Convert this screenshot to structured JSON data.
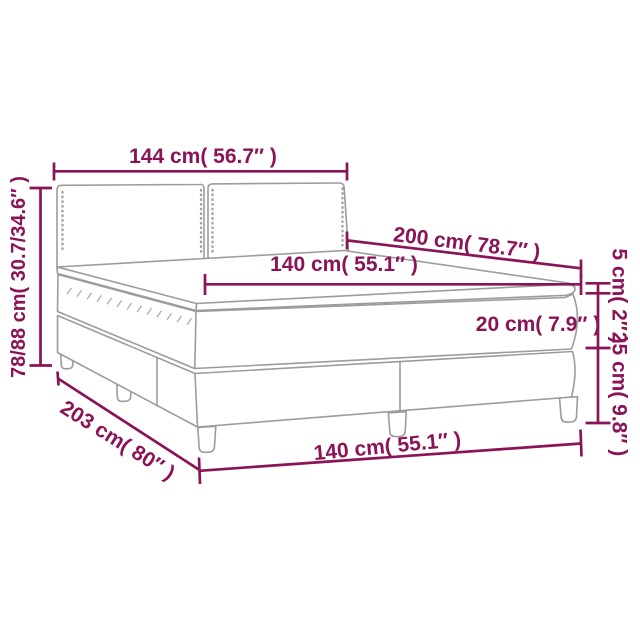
{
  "diagram": {
    "description": "Box spring bed with topper and mattress - dimension diagram",
    "colors": {
      "dimension_annotation": "#8a1457",
      "bed_outline": "#9c9c9c",
      "background": "#ffffff"
    },
    "labels": {
      "headboard_width": "144 cm( 56.7″ )",
      "bed_height_range": "78/88 cm( 30.7/34.6″ )",
      "bed_length": "200 cm( 78.7″ )",
      "mattress_width": "140 cm( 55.1″ )",
      "topper_thickness": "5 cm( 2″ )",
      "mattress_thickness": "20 cm( 7.9″ )",
      "base_height": "25 cm( 9.8″ )",
      "total_length": "203 cm( 80″ )",
      "base_width": "140 cm( 55.1″ )"
    }
  }
}
